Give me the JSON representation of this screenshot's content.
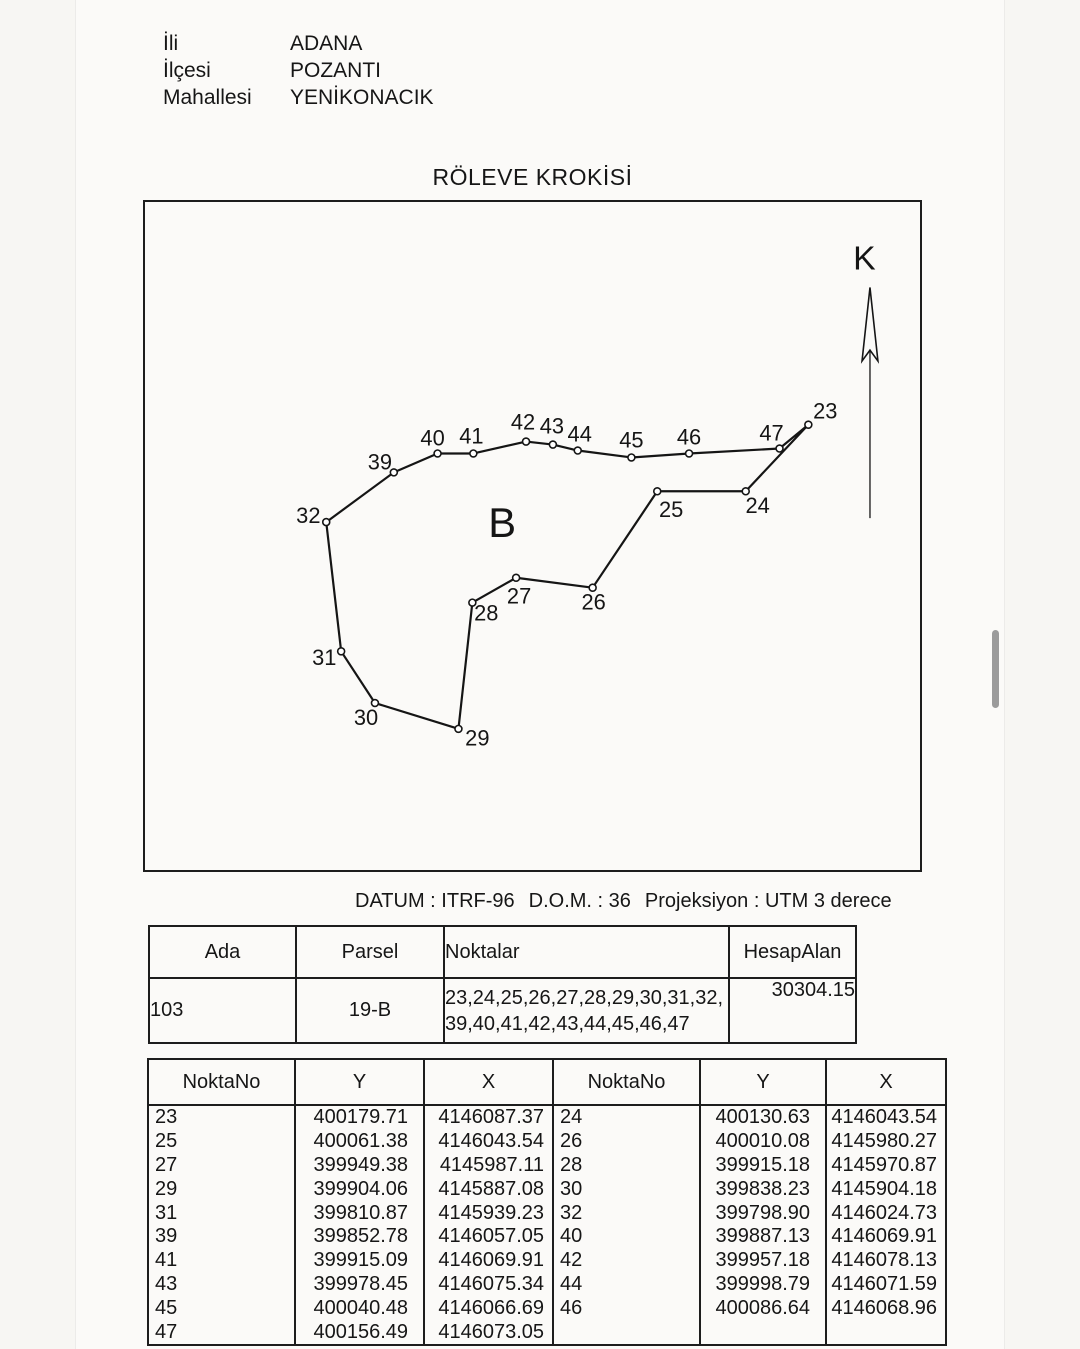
{
  "colors": {
    "ink": "#161616",
    "paper": "#fbfaf8",
    "scrollbar": "#9b9b9b"
  },
  "header": {
    "fields": [
      {
        "label": "İli",
        "value": "ADANA"
      },
      {
        "label": "İlçesi",
        "value": "POZANTI"
      },
      {
        "label": "Mahallesi",
        "value": "YENİKONACIK"
      }
    ]
  },
  "title": "RÖLEVE KROKİSİ",
  "sketch": {
    "north_label": "K",
    "block_label": "B",
    "points": [
      {
        "id": "23",
        "x": 667,
        "y": 224,
        "lx": 684,
        "ly": 218
      },
      {
        "id": "24",
        "x": 604,
        "y": 291,
        "lx": 616,
        "ly": 313
      },
      {
        "id": "25",
        "x": 515,
        "y": 291,
        "lx": 529,
        "ly": 317
      },
      {
        "id": "26",
        "x": 450,
        "y": 388,
        "lx": 451,
        "ly": 410
      },
      {
        "id": "27",
        "x": 373,
        "y": 378,
        "lx": 376,
        "ly": 404
      },
      {
        "id": "28",
        "x": 329,
        "y": 403,
        "lx": 343,
        "ly": 421
      },
      {
        "id": "29",
        "x": 315,
        "y": 530,
        "lx": 334,
        "ly": 547
      },
      {
        "id": "30",
        "x": 231,
        "y": 504,
        "lx": 222,
        "ly": 526
      },
      {
        "id": "31",
        "x": 197,
        "y": 452,
        "lx": 180,
        "ly": 466
      },
      {
        "id": "32",
        "x": 182,
        "y": 322,
        "lx": 164,
        "ly": 323
      },
      {
        "id": "39",
        "x": 250,
        "y": 272,
        "lx": 236,
        "ly": 269
      },
      {
        "id": "40",
        "x": 294,
        "y": 253,
        "lx": 289,
        "ly": 245
      },
      {
        "id": "41",
        "x": 330,
        "y": 253,
        "lx": 328,
        "ly": 243
      },
      {
        "id": "42",
        "x": 383,
        "y": 241,
        "lx": 380,
        "ly": 229
      },
      {
        "id": "43",
        "x": 410,
        "y": 244,
        "lx": 409,
        "ly": 233
      },
      {
        "id": "44",
        "x": 435,
        "y": 250,
        "lx": 437,
        "ly": 241
      },
      {
        "id": "45",
        "x": 489,
        "y": 257,
        "lx": 489,
        "ly": 247
      },
      {
        "id": "46",
        "x": 547,
        "y": 253,
        "lx": 547,
        "ly": 244
      },
      {
        "id": "47",
        "x": 638,
        "y": 248,
        "lx": 630,
        "ly": 240
      }
    ]
  },
  "datum": {
    "datum_text": "DATUM : ITRF-96",
    "dom_text": "D.O.M. : 36",
    "projection_text": "Projeksiyon : UTM 3 derece"
  },
  "parcel_table": {
    "headers": [
      "Ada",
      "Parsel",
      "Noktalar",
      "HesapAlan"
    ],
    "row": {
      "ada": "103",
      "parsel": "19-B",
      "noktalar_line1": "23,24,25,26,27,28,29,30,31,32,",
      "noktalar_line2": "39,40,41,42,43,44,45,46,47",
      "hesap_alan": "30304.15"
    }
  },
  "coord_table": {
    "headers": [
      "NoktaNo",
      "Y",
      "X",
      "NoktaNo",
      "Y",
      "X"
    ],
    "rows": [
      [
        "23",
        "400179.71",
        "4146087.37",
        "24",
        "400130.63",
        "4146043.54"
      ],
      [
        "25",
        "400061.38",
        "4146043.54",
        "26",
        "400010.08",
        "4145980.27"
      ],
      [
        "27",
        "399949.38",
        "4145987.11",
        "28",
        "399915.18",
        "4145970.87"
      ],
      [
        "29",
        "399904.06",
        "4145887.08",
        "30",
        "399838.23",
        "4145904.18"
      ],
      [
        "31",
        "399810.87",
        "4145939.23",
        "32",
        "399798.90",
        "4146024.73"
      ],
      [
        "39",
        "399852.78",
        "4146057.05",
        "40",
        "399887.13",
        "4146069.91"
      ],
      [
        "41",
        "399915.09",
        "4146069.91",
        "42",
        "399957.18",
        "4146078.13"
      ],
      [
        "43",
        "399978.45",
        "4146075.34",
        "44",
        "399998.79",
        "4146071.59"
      ],
      [
        "45",
        "400040.48",
        "4146066.69",
        "46",
        "400086.64",
        "4146068.96"
      ],
      [
        "47",
        "400156.49",
        "4146073.05",
        "",
        "",
        ""
      ]
    ]
  }
}
